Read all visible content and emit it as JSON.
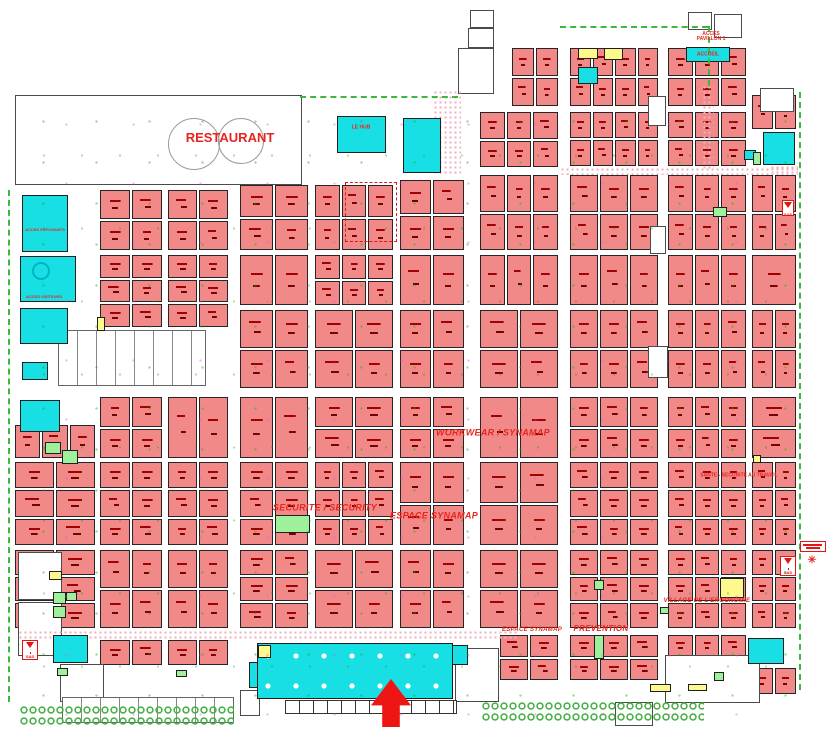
{
  "map_title": "Exhibition hall floor plan",
  "palette": {
    "booth": "#f28989",
    "special_cyan": "#18dfe4",
    "special_yellow": "#fdf98d",
    "special_green": "#9ff09b",
    "label_red": "#e8251f",
    "aisle_green": "#3cb93c",
    "arrow_red": "#ee1515"
  },
  "labels": [
    {
      "t": "RESTAURANT",
      "x": 230,
      "y": 138,
      "fs": 13,
      "cls": "",
      "name": "zone-label-restaurant"
    },
    {
      "t": "ACCES\nPAVILLON 1",
      "x": 711,
      "y": 37,
      "fs": 5,
      "cls": "",
      "name": "zone-label-acces-pavillon"
    },
    {
      "t": "ACCUEIL",
      "x": 708,
      "y": 55,
      "fs": 5,
      "cls": "",
      "name": "zone-label-accueil"
    },
    {
      "t": "LE HUB",
      "x": 361,
      "y": 128,
      "fs": 5,
      "cls": "",
      "name": "zone-label-le-hub"
    },
    {
      "t": "ACCES EXPOSANTS",
      "x": 45,
      "y": 230,
      "fs": 4,
      "cls": "",
      "name": "zone-label-acces-exposants"
    },
    {
      "t": "ACCES VISITEURS",
      "x": 44,
      "y": 297,
      "fs": 4,
      "cls": "",
      "name": "zone-label-acces-visiteurs"
    },
    {
      "t": "SECURITE / SECURITY",
      "x": 325,
      "y": 508,
      "fs": 9,
      "cls": "it",
      "name": "zone-label-securite"
    },
    {
      "t": "ESPACE SYNAMAP",
      "x": 434,
      "y": 516,
      "fs": 9,
      "cls": "it",
      "name": "zone-label-espace-synamap"
    },
    {
      "t": "WORKWEAR / SYNAMAP",
      "x": 493,
      "y": 433,
      "fs": 9,
      "cls": "it",
      "name": "zone-label-workwear-synamap"
    },
    {
      "t": "SANTE - SECURITE AU TRAVAIL",
      "x": 739,
      "y": 476,
      "fs": 5,
      "cls": "",
      "name": "zone-label-sante-securite"
    },
    {
      "t": "ESPACE SYNAMAP",
      "x": 532,
      "y": 630,
      "fs": 6,
      "cls": "it",
      "name": "zone-label-espace-synamap-sud"
    },
    {
      "t": "PREVENTION",
      "x": 601,
      "y": 629,
      "fs": 8,
      "cls": "it",
      "name": "zone-label-prevention"
    },
    {
      "t": "VILLAGE DE L'ERGONOMIE",
      "x": 707,
      "y": 601,
      "fs": 6,
      "cls": "it",
      "name": "zone-label-village-ergonomie"
    },
    {
      "t": "✳",
      "x": 812,
      "y": 561,
      "fs": 10,
      "cls": "",
      "name": "flower-marker"
    }
  ],
  "sas_label": "SAS",
  "booth_clusters": [
    [
      512,
      48,
      46,
      58,
      2,
      2
    ],
    [
      570,
      48,
      88,
      58,
      4,
      2
    ],
    [
      668,
      48,
      78,
      58,
      3,
      2
    ],
    [
      480,
      112,
      78,
      55,
      3,
      2
    ],
    [
      570,
      112,
      88,
      54,
      4,
      2
    ],
    [
      668,
      112,
      78,
      54,
      3,
      2
    ],
    [
      752,
      95,
      44,
      34,
      2,
      1
    ],
    [
      100,
      190,
      62,
      60,
      2,
      2
    ],
    [
      168,
      190,
      60,
      60,
      2,
      2
    ],
    [
      240,
      185,
      68,
      65,
      2,
      2
    ],
    [
      315,
      185,
      78,
      65,
      3,
      2
    ],
    [
      400,
      180,
      64,
      70,
      2,
      2
    ],
    [
      480,
      175,
      78,
      75,
      3,
      2
    ],
    [
      570,
      175,
      88,
      75,
      3,
      2
    ],
    [
      668,
      175,
      78,
      75,
      3,
      2
    ],
    [
      752,
      175,
      44,
      75,
      2,
      2
    ],
    [
      100,
      255,
      62,
      72,
      2,
      3
    ],
    [
      168,
      255,
      60,
      72,
      2,
      3
    ],
    [
      240,
      255,
      68,
      50,
      2,
      1
    ],
    [
      315,
      255,
      78,
      50,
      3,
      2
    ],
    [
      400,
      255,
      64,
      50,
      2,
      1
    ],
    [
      480,
      255,
      78,
      50,
      3,
      1
    ],
    [
      570,
      255,
      88,
      50,
      3,
      1
    ],
    [
      668,
      255,
      78,
      50,
      3,
      1
    ],
    [
      752,
      255,
      44,
      50,
      1,
      1
    ],
    [
      240,
      310,
      68,
      78,
      2,
      2
    ],
    [
      315,
      310,
      78,
      78,
      2,
      2
    ],
    [
      400,
      310,
      64,
      78,
      2,
      2
    ],
    [
      480,
      310,
      78,
      78,
      2,
      2
    ],
    [
      570,
      310,
      88,
      78,
      3,
      2
    ],
    [
      668,
      310,
      78,
      78,
      3,
      2
    ],
    [
      752,
      310,
      44,
      78,
      2,
      2
    ],
    [
      15,
      425,
      80,
      33,
      3,
      1
    ],
    [
      100,
      397,
      62,
      61,
      2,
      2
    ],
    [
      168,
      397,
      60,
      61,
      2,
      1
    ],
    [
      240,
      397,
      68,
      61,
      2,
      1
    ],
    [
      315,
      397,
      78,
      61,
      2,
      2
    ],
    [
      400,
      397,
      64,
      61,
      2,
      2
    ],
    [
      480,
      397,
      78,
      61,
      2,
      1
    ],
    [
      570,
      397,
      88,
      61,
      3,
      2
    ],
    [
      668,
      397,
      78,
      61,
      3,
      2
    ],
    [
      752,
      397,
      44,
      61,
      1,
      2
    ],
    [
      15,
      462,
      80,
      83,
      2,
      3
    ],
    [
      100,
      462,
      62,
      83,
      2,
      3
    ],
    [
      168,
      462,
      60,
      83,
      2,
      3
    ],
    [
      240,
      462,
      68,
      83,
      2,
      3
    ],
    [
      315,
      462,
      78,
      83,
      3,
      3
    ],
    [
      400,
      462,
      64,
      83,
      2,
      2
    ],
    [
      480,
      462,
      78,
      83,
      2,
      2
    ],
    [
      570,
      462,
      88,
      83,
      3,
      3
    ],
    [
      668,
      462,
      78,
      83,
      3,
      3
    ],
    [
      752,
      462,
      44,
      83,
      2,
      3
    ],
    [
      15,
      550,
      80,
      78,
      2,
      3
    ],
    [
      100,
      550,
      62,
      78,
      2,
      2
    ],
    [
      168,
      550,
      60,
      78,
      2,
      2
    ],
    [
      240,
      550,
      68,
      78,
      2,
      3
    ],
    [
      315,
      550,
      78,
      78,
      2,
      2
    ],
    [
      400,
      550,
      64,
      78,
      2,
      2
    ],
    [
      480,
      550,
      78,
      78,
      2,
      2
    ],
    [
      570,
      550,
      88,
      78,
      3,
      3
    ],
    [
      668,
      550,
      78,
      78,
      3,
      3
    ],
    [
      752,
      550,
      44,
      78,
      2,
      3
    ],
    [
      100,
      640,
      62,
      25,
      2,
      1
    ],
    [
      168,
      640,
      60,
      25,
      2,
      1
    ],
    [
      500,
      635,
      58,
      45,
      2,
      2
    ],
    [
      570,
      635,
      88,
      45,
      3,
      2
    ],
    [
      668,
      635,
      78,
      45,
      3,
      2
    ],
    [
      752,
      668,
      44,
      26,
      2,
      1
    ],
    [
      95,
      140,
      48,
      28,
      2,
      1
    ],
    [
      160,
      148,
      22,
      20,
      1,
      1
    ]
  ],
  "features": [
    {
      "cls": "outline",
      "x": 15,
      "y": 95,
      "w": 287,
      "h": 90,
      "name": "restaurant-building"
    },
    {
      "cls": "arc",
      "x": 168,
      "y": 118,
      "w": 52,
      "h": 52,
      "name": "restaurant-arc"
    },
    {
      "cls": "arc",
      "x": 218,
      "y": 118,
      "w": 46,
      "h": 46,
      "name": "restaurant-arc"
    },
    {
      "cls": "outline",
      "x": 468,
      "y": 28,
      "w": 26,
      "h": 20,
      "name": "building-structure"
    },
    {
      "cls": "outline",
      "x": 458,
      "y": 48,
      "w": 36,
      "h": 46,
      "name": "building-structure"
    },
    {
      "cls": "outline",
      "x": 470,
      "y": 10,
      "w": 24,
      "h": 18,
      "name": "building-structure"
    },
    {
      "cls": "outline",
      "x": 688,
      "y": 12,
      "w": 24,
      "h": 18,
      "name": "building-structure"
    },
    {
      "cls": "outline",
      "x": 714,
      "y": 14,
      "w": 28,
      "h": 24,
      "name": "building-structure"
    },
    {
      "cls": "outline",
      "x": 760,
      "y": 88,
      "w": 34,
      "h": 24,
      "name": "building-structure"
    },
    {
      "cls": "outline",
      "x": 648,
      "y": 96,
      "w": 18,
      "h": 30,
      "name": "building-structure"
    },
    {
      "cls": "outline",
      "x": 650,
      "y": 226,
      "w": 16,
      "h": 28,
      "name": "building-structure"
    },
    {
      "cls": "outline",
      "x": 648,
      "y": 346,
      "w": 20,
      "h": 32,
      "name": "building-structure"
    },
    {
      "cls": "outline",
      "x": 18,
      "y": 552,
      "w": 44,
      "h": 48,
      "name": "building-structure"
    },
    {
      "cls": "outline",
      "x": 18,
      "y": 602,
      "w": 44,
      "h": 54,
      "name": "building-structure"
    },
    {
      "cls": "outline",
      "x": 60,
      "y": 664,
      "w": 44,
      "h": 38,
      "name": "building-structure"
    },
    {
      "cls": "outline",
      "x": 455,
      "y": 648,
      "w": 44,
      "h": 54,
      "name": "building-structure"
    },
    {
      "cls": "outline",
      "x": 665,
      "y": 655,
      "w": 95,
      "h": 48,
      "name": "building-structure"
    },
    {
      "cls": "outline",
      "x": 615,
      "y": 702,
      "w": 38,
      "h": 24,
      "name": "building-structure"
    },
    {
      "cls": "outline",
      "x": 240,
      "y": 690,
      "w": 20,
      "h": 26,
      "name": "building-structure"
    },
    {
      "cls": "stallsL",
      "x": 58,
      "y": 330,
      "w": 148,
      "h": 56,
      "name": "concourse"
    },
    {
      "cls": "pinkdot",
      "x": 560,
      "y": 167,
      "w": 238,
      "h": 8,
      "name": "walkway"
    },
    {
      "cls": "pinkdot",
      "x": 702,
      "y": 85,
      "w": 12,
      "h": 84,
      "name": "walkway"
    },
    {
      "cls": "pinkdot",
      "x": 433,
      "y": 90,
      "w": 28,
      "h": 84,
      "name": "walkway"
    },
    {
      "cls": "pinkdot",
      "x": 18,
      "y": 630,
      "w": 500,
      "h": 9,
      "name": "walkway"
    },
    {
      "cls": "pinkdot",
      "x": 770,
      "y": 165,
      "w": 28,
      "h": 8,
      "name": "walkway"
    },
    {
      "cls": "cyan",
      "x": 22,
      "y": 195,
      "w": 46,
      "h": 57,
      "name": "acces-exposants-zone"
    },
    {
      "cls": "cyan",
      "x": 20,
      "y": 256,
      "w": 56,
      "h": 46,
      "name": "cyan-zone"
    },
    {
      "cls": "ring",
      "x": 32,
      "y": 262,
      "w": 18,
      "h": 18,
      "name": "circle-marker"
    },
    {
      "cls": "cyan",
      "x": 20,
      "y": 308,
      "w": 48,
      "h": 36,
      "name": "acces-visiteurs-zone"
    },
    {
      "cls": "cyan",
      "x": 22,
      "y": 362,
      "w": 26,
      "h": 18,
      "name": "cyan-zone"
    },
    {
      "cls": "cyan",
      "x": 20,
      "y": 400,
      "w": 40,
      "h": 32,
      "name": "cyan-zone"
    },
    {
      "cls": "cyan",
      "x": 337,
      "y": 116,
      "w": 49,
      "h": 37,
      "name": "le-hub-zone"
    },
    {
      "cls": "cyan",
      "x": 403,
      "y": 118,
      "w": 38,
      "h": 55,
      "name": "plateau-tv-zone"
    },
    {
      "cls": "cyan",
      "x": 686,
      "y": 47,
      "w": 44,
      "h": 15,
      "name": "accueil-zone"
    },
    {
      "cls": "cyan",
      "x": 763,
      "y": 132,
      "w": 32,
      "h": 33,
      "name": "cyan-zone"
    },
    {
      "cls": "cyan",
      "x": 578,
      "y": 67,
      "w": 20,
      "h": 17,
      "name": "cyan-zone"
    },
    {
      "cls": "cyan",
      "x": 744,
      "y": 150,
      "w": 12,
      "h": 10,
      "name": "cyan-zone"
    },
    {
      "cls": "cyan",
      "x": 257,
      "y": 643,
      "w": 196,
      "h": 56,
      "name": "entrance-plaza"
    },
    {
      "cls": "pillars",
      "x": 265,
      "y": 653,
      "w": 180,
      "h": 40,
      "name": "entrance-pillars"
    },
    {
      "cls": "cyan",
      "x": 249,
      "y": 662,
      "w": 9,
      "h": 26,
      "name": "entrance-plaza"
    },
    {
      "cls": "cyan",
      "x": 452,
      "y": 645,
      "w": 16,
      "h": 20,
      "name": "entrance-plaza"
    },
    {
      "cls": "cyan",
      "x": 53,
      "y": 635,
      "w": 35,
      "h": 28,
      "name": "cyan-zone"
    },
    {
      "cls": "cyan",
      "x": 748,
      "y": 638,
      "w": 36,
      "h": 26,
      "name": "cyan-zone"
    },
    {
      "cls": "yellow",
      "x": 578,
      "y": 48,
      "w": 20,
      "h": 11,
      "name": "yellow-zone"
    },
    {
      "cls": "yellow",
      "x": 604,
      "y": 48,
      "w": 19,
      "h": 12,
      "name": "yellow-zone"
    },
    {
      "cls": "yellow",
      "x": 97,
      "y": 317,
      "w": 8,
      "h": 14,
      "name": "yellow-zone"
    },
    {
      "cls": "yellow",
      "x": 49,
      "y": 571,
      "w": 13,
      "h": 9,
      "name": "yellow-zone"
    },
    {
      "cls": "yellow",
      "x": 720,
      "y": 578,
      "w": 24,
      "h": 20,
      "name": "yellow-zone"
    },
    {
      "cls": "yellow",
      "x": 650,
      "y": 684,
      "w": 21,
      "h": 8,
      "name": "yellow-zone"
    },
    {
      "cls": "yellow",
      "x": 688,
      "y": 684,
      "w": 19,
      "h": 7,
      "name": "yellow-zone"
    },
    {
      "cls": "yellow",
      "x": 258,
      "y": 645,
      "w": 13,
      "h": 13,
      "name": "yellow-zone"
    },
    {
      "cls": "yellow",
      "x": 753,
      "y": 455,
      "w": 8,
      "h": 8,
      "name": "yellow-zone"
    },
    {
      "cls": "green",
      "x": 275,
      "y": 515,
      "w": 35,
      "h": 18,
      "name": "green-zone"
    },
    {
      "cls": "green",
      "x": 713,
      "y": 207,
      "w": 14,
      "h": 10,
      "name": "green-zone"
    },
    {
      "cls": "green",
      "x": 45,
      "y": 442,
      "w": 16,
      "h": 12,
      "name": "green-zone"
    },
    {
      "cls": "green",
      "x": 62,
      "y": 450,
      "w": 16,
      "h": 14,
      "name": "green-zone"
    },
    {
      "cls": "green",
      "x": 594,
      "y": 580,
      "w": 10,
      "h": 10,
      "name": "green-zone"
    },
    {
      "cls": "green",
      "x": 660,
      "y": 607,
      "w": 9,
      "h": 7,
      "name": "green-zone"
    },
    {
      "cls": "green",
      "x": 594,
      "y": 635,
      "w": 10,
      "h": 24,
      "name": "green-zone"
    },
    {
      "cls": "green",
      "x": 714,
      "y": 672,
      "w": 10,
      "h": 9,
      "name": "green-zone"
    },
    {
      "cls": "green",
      "x": 53,
      "y": 592,
      "w": 13,
      "h": 12,
      "name": "green-zone"
    },
    {
      "cls": "green",
      "x": 66,
      "y": 592,
      "w": 11,
      "h": 9,
      "name": "green-zone"
    },
    {
      "cls": "green",
      "x": 53,
      "y": 606,
      "w": 13,
      "h": 12,
      "name": "green-zone"
    },
    {
      "cls": "green",
      "x": 57,
      "y": 668,
      "w": 11,
      "h": 8,
      "name": "green-zone"
    },
    {
      "cls": "green",
      "x": 753,
      "y": 152,
      "w": 8,
      "h": 13,
      "name": "green-zone"
    },
    {
      "cls": "green",
      "x": 176,
      "y": 670,
      "w": 11,
      "h": 7,
      "name": "green-zone"
    },
    {
      "cls": "reddash",
      "x": 345,
      "y": 182,
      "w": 52,
      "h": 60,
      "name": "red-dashed-boundary"
    },
    {
      "cls": "stalls",
      "x": 285,
      "y": 700,
      "w": 172,
      "h": 14,
      "name": "stall-row"
    },
    {
      "cls": "stallsL",
      "x": 62,
      "y": 697,
      "w": 172,
      "h": 26,
      "name": "stall-row"
    },
    {
      "cls": "chain",
      "x": 20,
      "y": 706,
      "w": 214,
      "h": 9,
      "name": "aisle-chain"
    },
    {
      "cls": "chain",
      "x": 20,
      "y": 717,
      "w": 214,
      "h": 9,
      "name": "aisle-chain"
    },
    {
      "cls": "chain",
      "x": 482,
      "y": 702,
      "w": 222,
      "h": 9,
      "name": "aisle-chain"
    },
    {
      "cls": "chain",
      "x": 482,
      "y": 713,
      "w": 222,
      "h": 9,
      "name": "aisle-chain"
    },
    {
      "cls": "dashV",
      "x": 8,
      "y": 190,
      "w": 2,
      "h": 512,
      "name": "aisle-dashed-line"
    },
    {
      "cls": "dashV",
      "x": 799,
      "y": 92,
      "w": 2,
      "h": 598,
      "name": "aisle-dashed-line"
    },
    {
      "cls": "dashH",
      "x": 300,
      "y": 96,
      "w": 158,
      "h": 2,
      "name": "aisle-dashed-line"
    },
    {
      "cls": "dashH",
      "x": 560,
      "y": 26,
      "w": 148,
      "h": 2,
      "name": "aisle-dashed-line"
    },
    {
      "cls": "dashV",
      "x": 708,
      "y": 26,
      "w": 2,
      "h": 60,
      "name": "aisle-dashed-line"
    },
    {
      "cls": "redtag",
      "x": 800,
      "y": 541,
      "w": 26,
      "h": 11,
      "name": "red-note-tag"
    },
    {
      "cls": "sasbox",
      "x": 22,
      "y": 640,
      "w": 16,
      "h": 20,
      "name": "sas-entrance"
    },
    {
      "cls": "sasbox",
      "x": 780,
      "y": 556,
      "w": 16,
      "h": 20,
      "name": "sas-entrance"
    },
    {
      "cls": "sasbox",
      "x": 782,
      "y": 200,
      "w": 12,
      "h": 16,
      "name": "sas-entrance"
    }
  ],
  "arrow": {
    "x": 371,
    "y": 679,
    "w": 40,
    "h": 48,
    "head_h_pct": 55,
    "shaft_w_pct": 44
  }
}
